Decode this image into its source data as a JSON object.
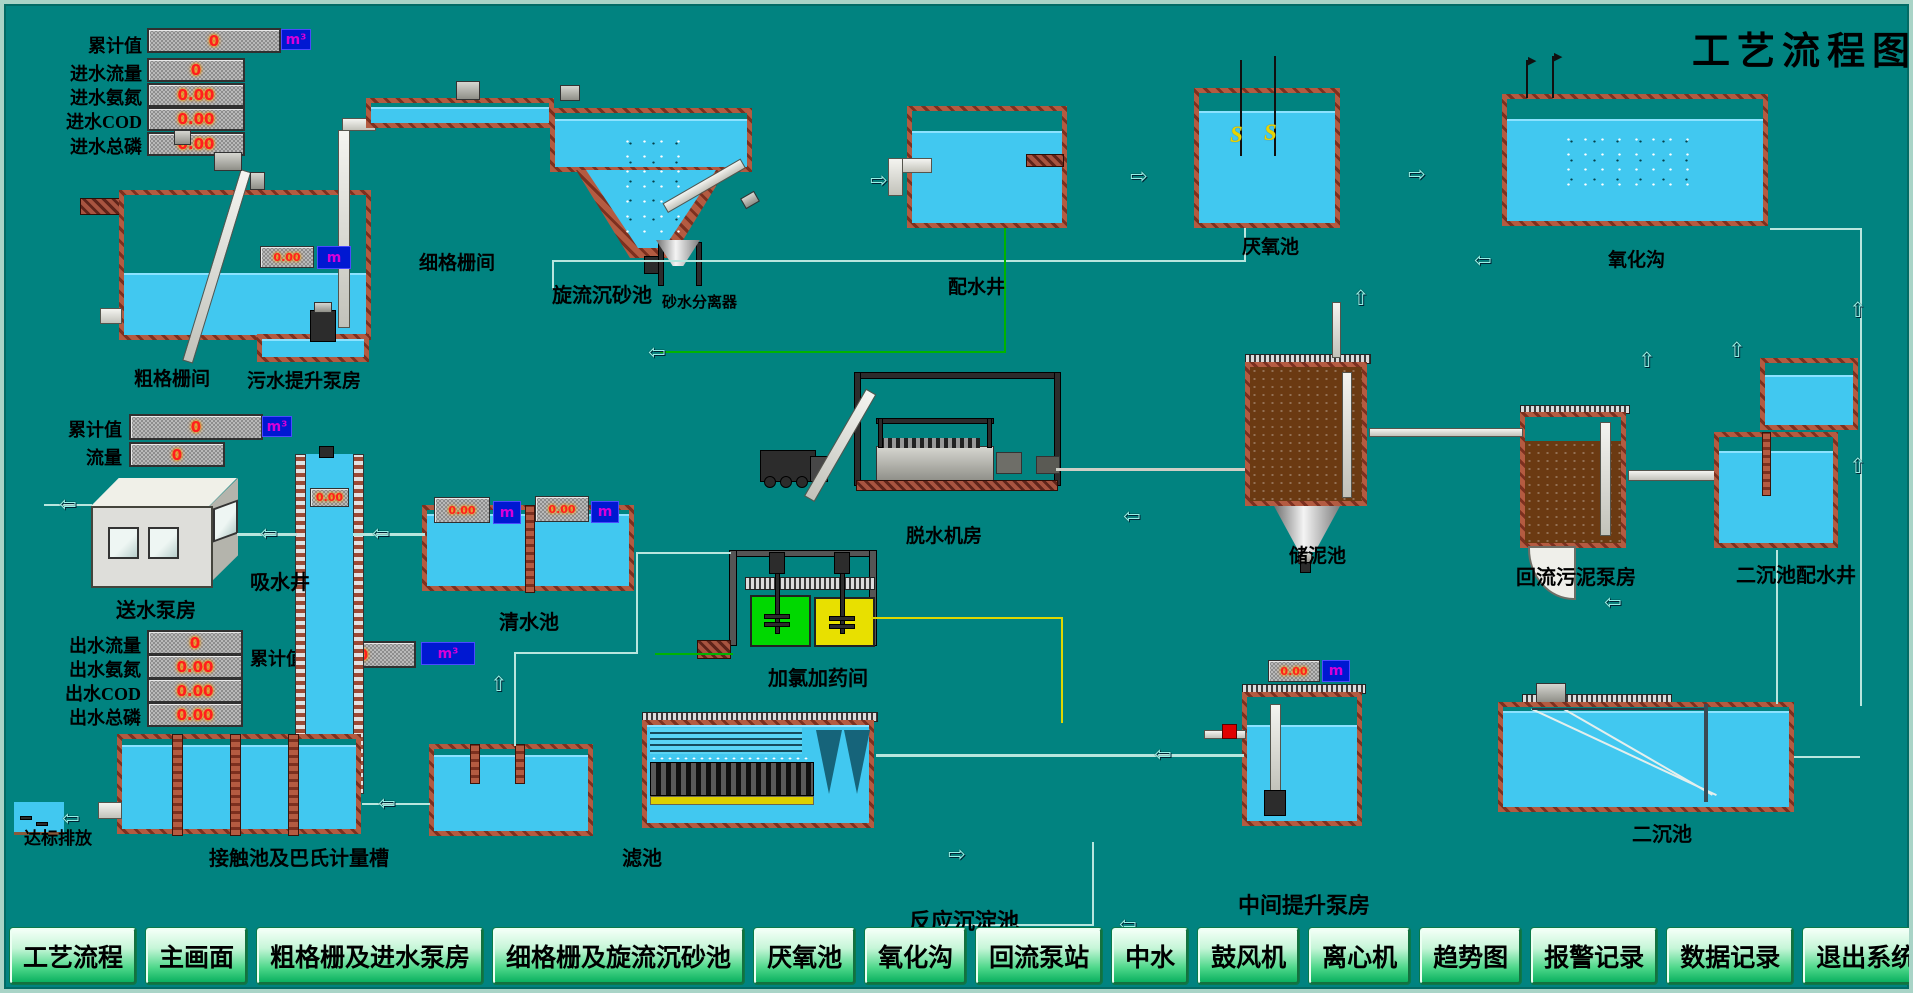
{
  "title": "工艺流程图",
  "panels": {
    "inlet": {
      "rows": [
        {
          "label": "累计值",
          "value": "0",
          "unit": "m³"
        },
        {
          "label": "进水流量",
          "value": "0"
        },
        {
          "label": "进水氨氮",
          "value": "0.00"
        },
        {
          "label": "进水COD",
          "value": "0.00"
        },
        {
          "label": "进水总磷",
          "value": "0.00"
        }
      ]
    },
    "supply": {
      "rows": [
        {
          "label": "累计值",
          "value": "0",
          "unit": "m³"
        },
        {
          "label": "流量",
          "value": "0"
        }
      ]
    },
    "outlet": {
      "rows": [
        {
          "label": "出水流量",
          "value": "0"
        },
        {
          "label": "出水氨氮",
          "value": "0.00"
        },
        {
          "label": "出水COD",
          "value": "0.00"
        },
        {
          "label": "出水总磷",
          "value": "0.00"
        }
      ]
    },
    "outlet_total": {
      "label": "累计值",
      "value": "0",
      "unit": "m³"
    }
  },
  "displays": {
    "lift_pump_level": {
      "value": "0.00",
      "unit": "m"
    },
    "clearwell_level_1": {
      "value": "0.00",
      "unit": "m"
    },
    "clearwell_level_2": {
      "value": "0.00",
      "unit": "m"
    },
    "suction_well_level": {
      "value": "0.00"
    },
    "mid_lift_level": {
      "value": "0.00",
      "unit": "m"
    }
  },
  "labels": {
    "coarse_screen_room": "粗格栅间",
    "sewage_lift_station": "污水提升泵房",
    "fine_screen_room": "细格栅间",
    "vortex_grit_chamber": "旋流沉砂池",
    "grit_water_separator": "砂水分离器",
    "distribution_well": "配水井",
    "anaerobic_tank": "厌氧池",
    "oxidation_ditch": "氧化沟",
    "dewatering_room": "脱水机房",
    "sludge_storage_tank": "储泥池",
    "return_sludge_pump_station": "回流污泥泵房",
    "secondary_distribution_well": "二沉池配水井",
    "suction_well": "吸水井",
    "water_supply_pump_station": "送水泵房",
    "clear_water_tank": "清水池",
    "chlorine_dosing_room": "加氯加药间",
    "standard_discharge": "达标排放",
    "contact_tank": "接触池及巴氏计量槽",
    "filter_tank": "滤池",
    "reaction_sedimentation_tank": "反应沉淀池",
    "intermediate_lift_station": "中间提升泵房",
    "secondary_clarifier": "二沉池"
  },
  "nav": {
    "items": [
      "工艺流程",
      "主画面",
      "粗格栅及进水泵房",
      "细格栅及旋流沉砂池",
      "厌氧池",
      "氧化沟",
      "回流泵站",
      "中水",
      "鼓风机",
      "离心机",
      "趋势图",
      "报警记录",
      "数据记录",
      "退出系统"
    ]
  },
  "colors": {
    "background": "#018380",
    "water": "#41c8f0",
    "brick": "#9c4a35",
    "value_red": "#ff1f1f",
    "badge_blue": "#0018d2",
    "badge_text": "#d800d8",
    "button_green": "#0cb160",
    "line_green": "#00b400",
    "line_yellow": "#ded800",
    "dosing_tank_green": "#00d800",
    "dosing_tank_yellow": "#e8e000",
    "sludge_brown": "#6b3a12"
  }
}
